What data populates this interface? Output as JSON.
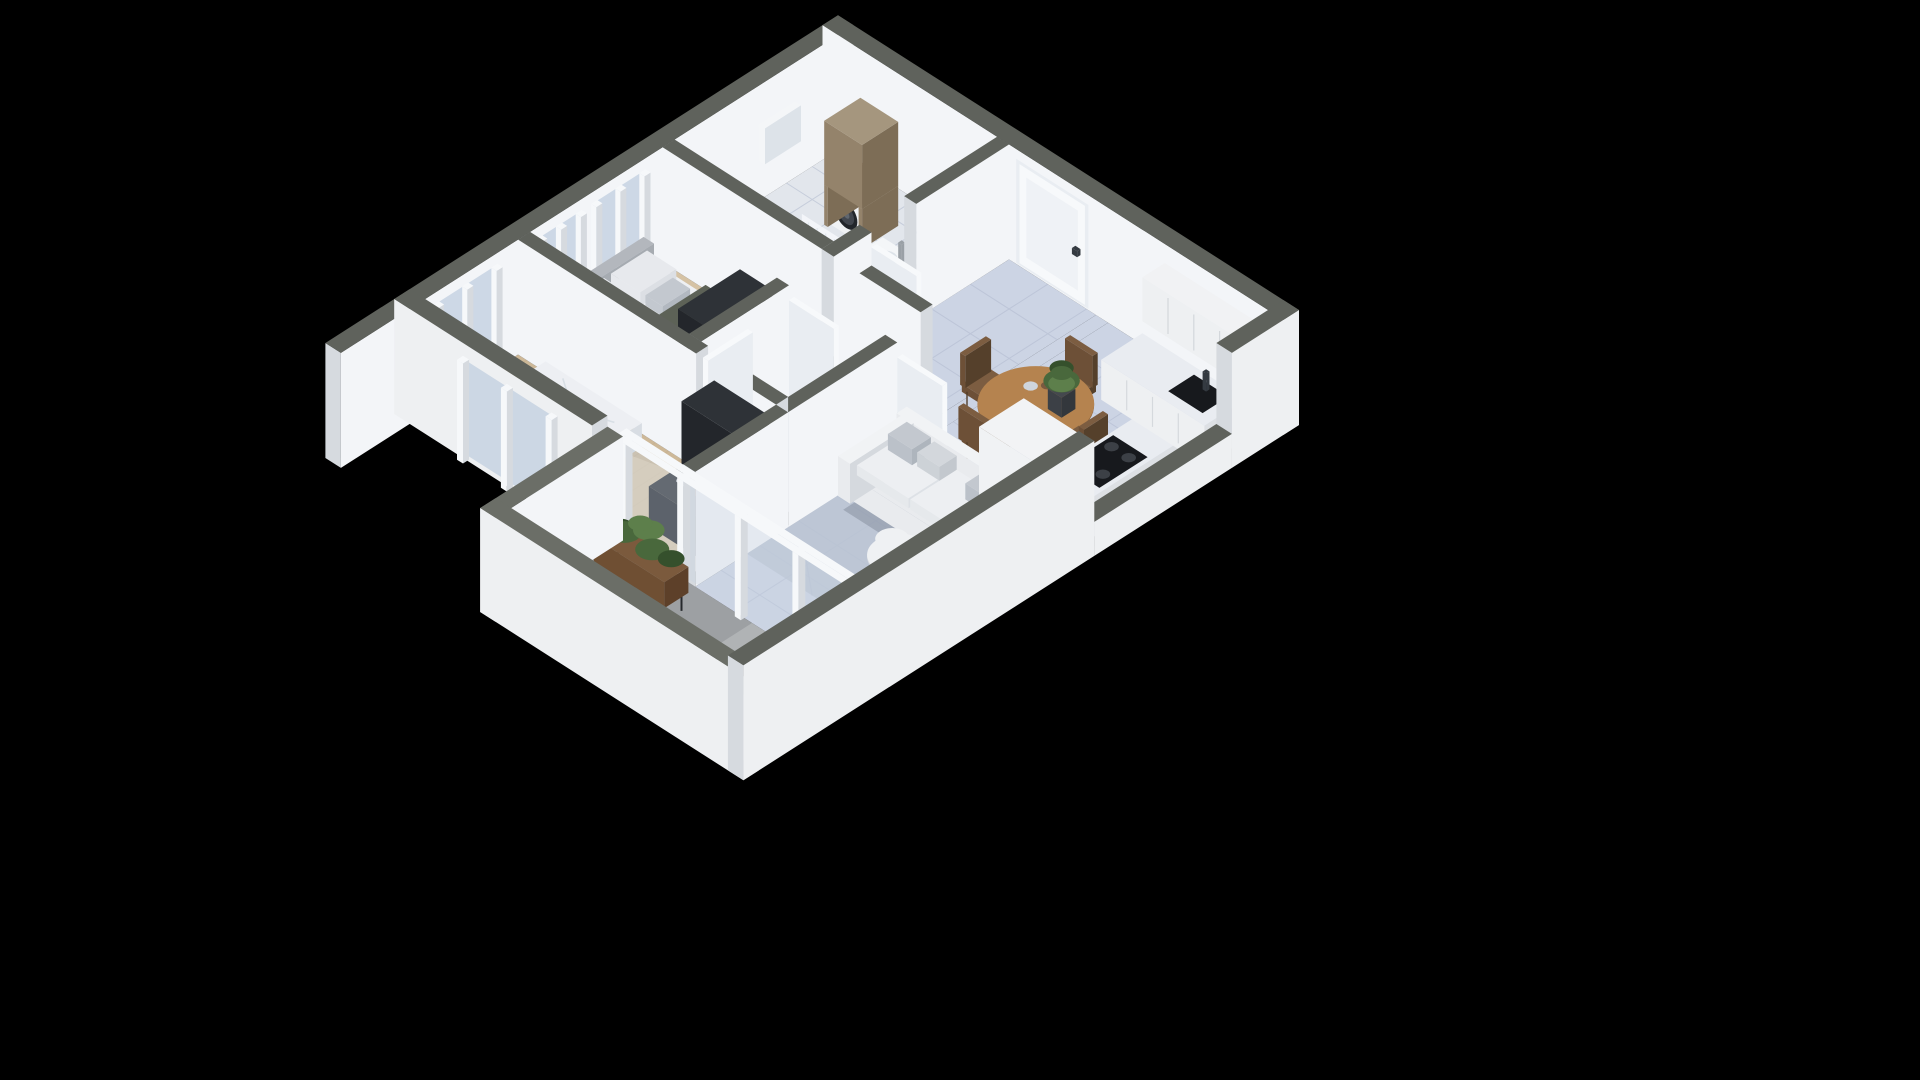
{
  "scene": {
    "label": "3D isometric cutaway floor plan render of a two-bedroom apartment on a black background",
    "type": "isometric-floorplan-3d-render",
    "background": "#000000",
    "rooms": [
      {
        "name": "bathroom-laundry",
        "furniture": [
          "bathtub",
          "washing-machine",
          "laundry-cabinet",
          "sink-vanity",
          "shower-curtain",
          "towel-rail"
        ]
      },
      {
        "name": "entry-hall",
        "furniture": [
          "front-door"
        ]
      },
      {
        "name": "bedroom-1",
        "furniture": [
          "double-bed",
          "wardrobe",
          "dresser",
          "area-rug",
          "windows"
        ]
      },
      {
        "name": "hallway",
        "furniture": [
          "interior-door-leaves"
        ]
      },
      {
        "name": "bedroom-2",
        "furniture": [
          "double-bed",
          "wardrobe",
          "desk",
          "window"
        ]
      },
      {
        "name": "living-room",
        "furniture": [
          "sofa",
          "throw-pillows",
          "area-rug",
          "coffee-table",
          "round-dining-table",
          "dining-chairs",
          "table-plant"
        ]
      },
      {
        "name": "kitchen",
        "furniture": [
          "upper-cabinets",
          "counter-with-sink",
          "faucet",
          "cooktop",
          "fridge-volume"
        ]
      },
      {
        "name": "balcony",
        "furniture": [
          "fern-planter",
          "lounge-chair",
          "lounge-chair",
          "low-table"
        ]
      }
    ]
  },
  "palette": {
    "bg": "#000000",
    "wallTop": "#5f625c",
    "wallTopLight": "#6b6e67",
    "wallInner": "#f3f5f8",
    "wallInnerShade": "#e0e5ec",
    "wallCap": "#d6dadf",
    "wallOuter": "#eef0f2",
    "floorMarble": "#ccd4e4",
    "tileLine": "#aab4c9",
    "vein": "#98a4bc",
    "floorBath": "#e2e6ec",
    "floorWood": "#d5c2a4",
    "floorWood2": "#cdb898",
    "woodLine": "#bfab8a",
    "woodSun": "#f0e1c3",
    "floorBalcony": "#9da0a3",
    "balconySun": "#c3c5c7",
    "rugGray": "#9ba3ad",
    "rugBlue": "#bac3d2",
    "glass": "#c9d5e3",
    "framePost": "#f6f8fa",
    "doorWhite": "#f7f9fb",
    "doorShade": "#e9edf2",
    "handleDark": "#343a41",
    "bedFrame": "#c9ccd1",
    "mattress": "#eef0f3",
    "pillow": "#e7e9ed",
    "cushionGray": "#c3c8cf",
    "blanket": "#5d6257",
    "blanketSide": "#4b5045",
    "headboard": "#b3b7bd",
    "duvet": "#edeff3",
    "duvetFold": "#d7dde4",
    "darkWood": "#94836b",
    "darkWoodSide": "#7d6d56",
    "darkWoodTop": "#a5967e",
    "washerWhite": "#f0f2f4",
    "washerDark": "#22262b",
    "washerGlass": "#41464e",
    "porcelain": "#f4f6f8",
    "porcelainShade": "#dde3e9",
    "furnDark": "#23262b",
    "furnDarkSide": "#191c20",
    "furnDarkTop": "#2e3237",
    "clothA": "#5a626c",
    "clothB": "#8d939b",
    "leather": "#6f4f35",
    "tableWood": "#b5834f",
    "tableWoodSide": "#96693c",
    "chairBrown": "#6d5037",
    "chairBrownSide": "#55402b",
    "chairBrownTop": "#7c5d41",
    "chairLeg": "#503c28",
    "plantGreen": "#49683c",
    "plantGreenDark": "#35502c",
    "plantGreenLight": "#5d7f4b",
    "sofaWhite": "#e9ebee",
    "sofaShade": "#d5d9de",
    "sofaTop": "#f1f3f5",
    "coffeeWhite": "#eff1f3",
    "counterWhite": "#eef0f2",
    "counterSide": "#dde0e4",
    "marbleTop": "#e9ecf1",
    "applianceBlack": "#17191d",
    "burnerGray": "#3c4046",
    "steel": "#9aa0a6",
    "mint": "#b5d1bf",
    "mintDark": "#95b7a2",
    "olive": "#5c6057",
    "oliveTop": "#686c5f",
    "planterPot": "#6f4f33",
    "standDark": "#26292c",
    "shadow": "rgba(15,20,35,0.16)"
  }
}
